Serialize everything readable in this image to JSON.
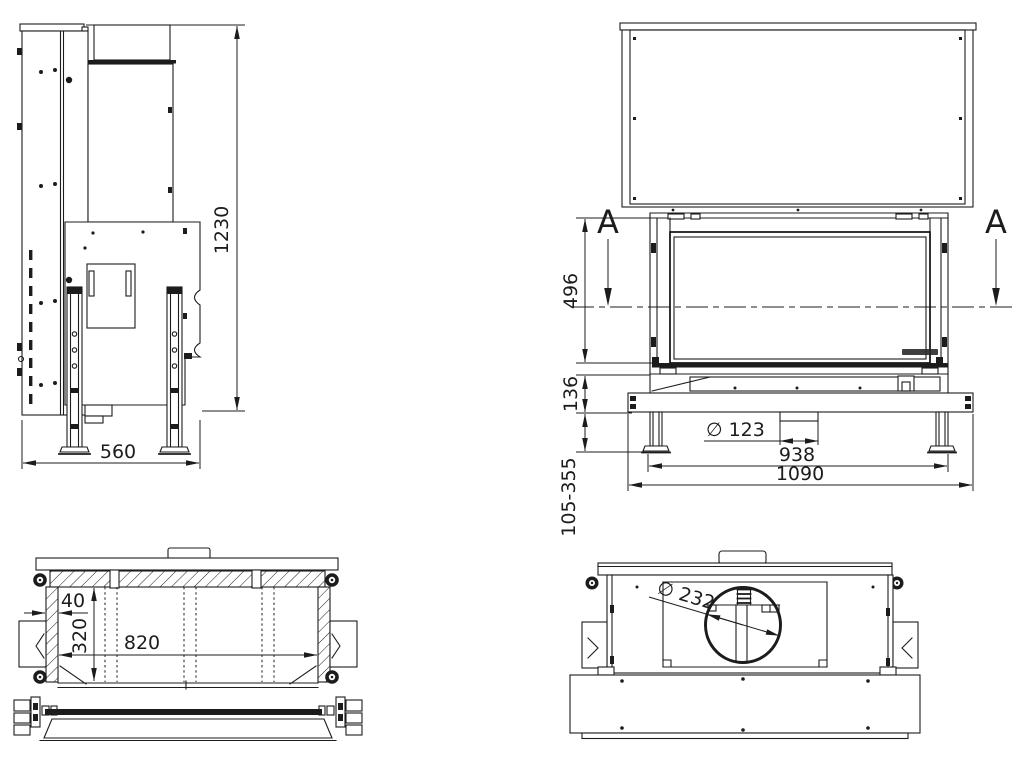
{
  "colors": {
    "ink": "#1c1c1c",
    "background": "#ffffff"
  },
  "side": {
    "height": "1230",
    "depth": "560"
  },
  "front": {
    "section_left": "A",
    "section_right": "A",
    "glass_height": "496",
    "base_height": "136",
    "leg_range": "105-355",
    "intake_dia": "∅ 123",
    "leg_span": "938",
    "width": "1090"
  },
  "section": {
    "wall": "40",
    "depth": "320",
    "width": "820"
  },
  "top": {
    "flue_dia": "∅ 232"
  }
}
